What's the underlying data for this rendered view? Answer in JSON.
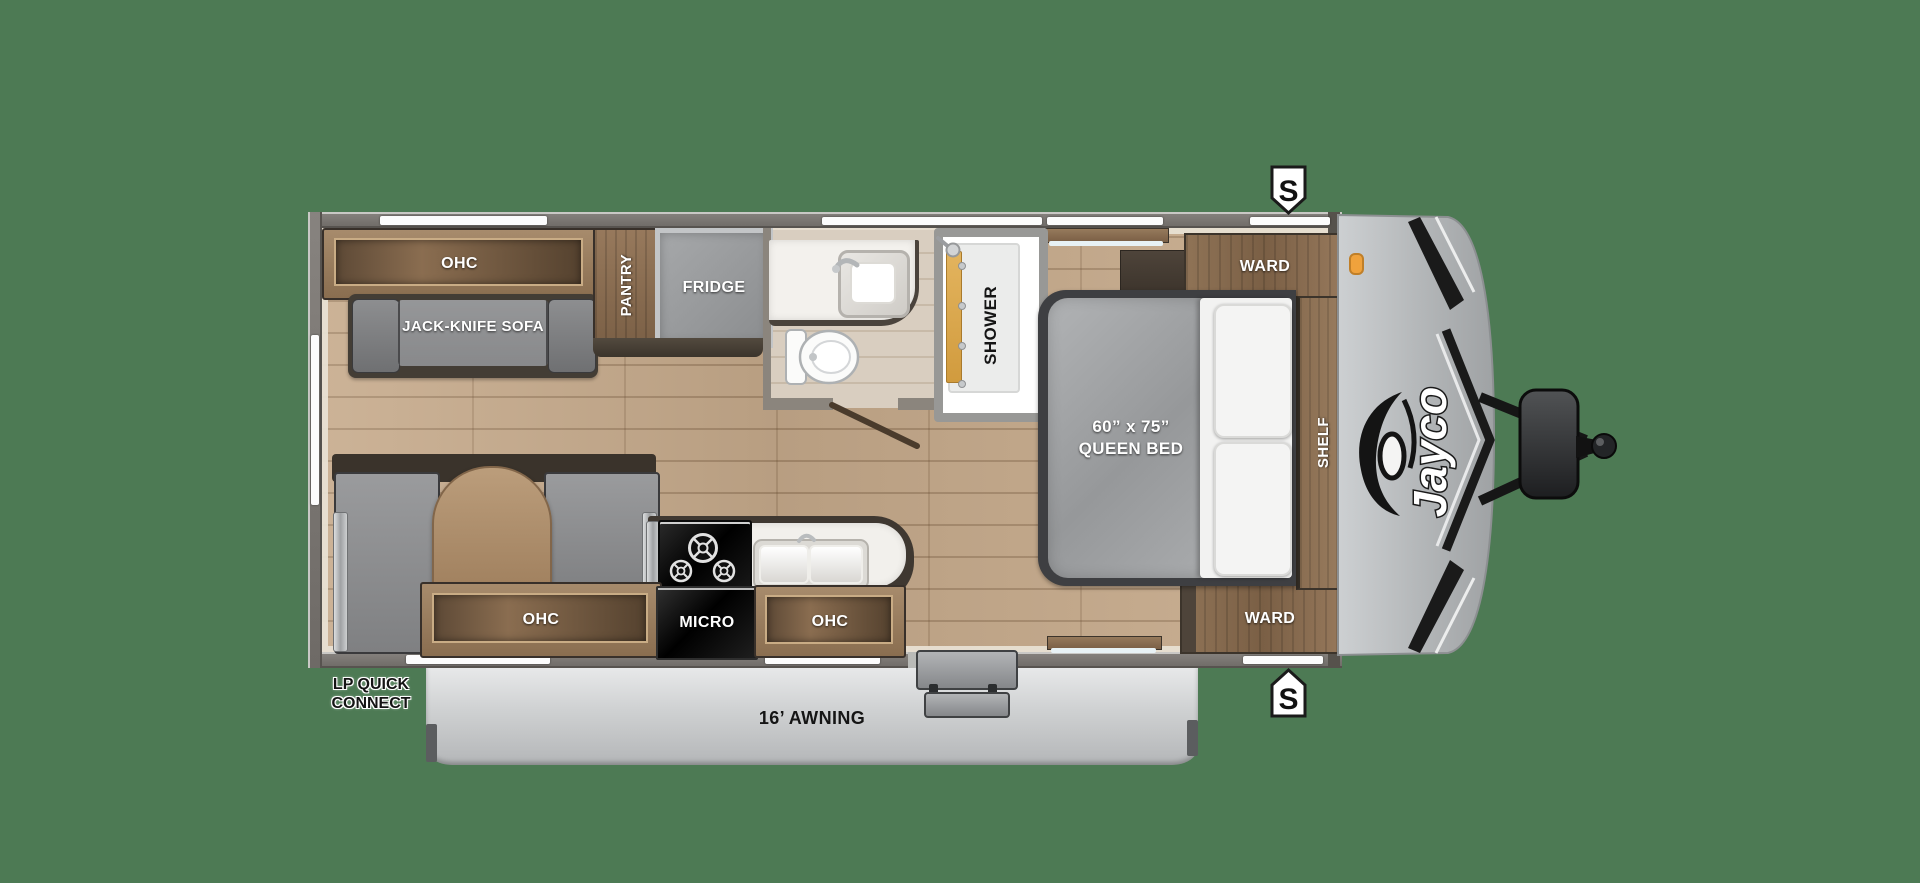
{
  "colors": {
    "background": "#4d7a54",
    "floor_wood": "#c6aa8b",
    "cabinet_wood": "#8a6e50",
    "awning_gray": "#cfd1d3",
    "cap_gray": "#b3b6b8"
  },
  "brand": {
    "logo": "Jayco"
  },
  "speakers": {
    "top": "S",
    "bottom": "S"
  },
  "labels": {
    "rear_ohc": "OHC",
    "sofa": "JACK-KNIFE SOFA",
    "pantry": "PANTRY",
    "fridge": "FRIDGE",
    "shower": "SHOWER",
    "bed_size": "60” x 75”",
    "bed_type": "QUEEN BED",
    "ward_top": "WARD",
    "shelf": "SHELF",
    "ward_bottom": "WARD",
    "kitchen_ohc_left": "OHC",
    "micro": "MICRO",
    "kitchen_ohc_right": "OHC"
  },
  "exterior": {
    "awning": "16’ AWNING",
    "lp_line1": "LP QUICK",
    "lp_line2": "CONNECT"
  }
}
